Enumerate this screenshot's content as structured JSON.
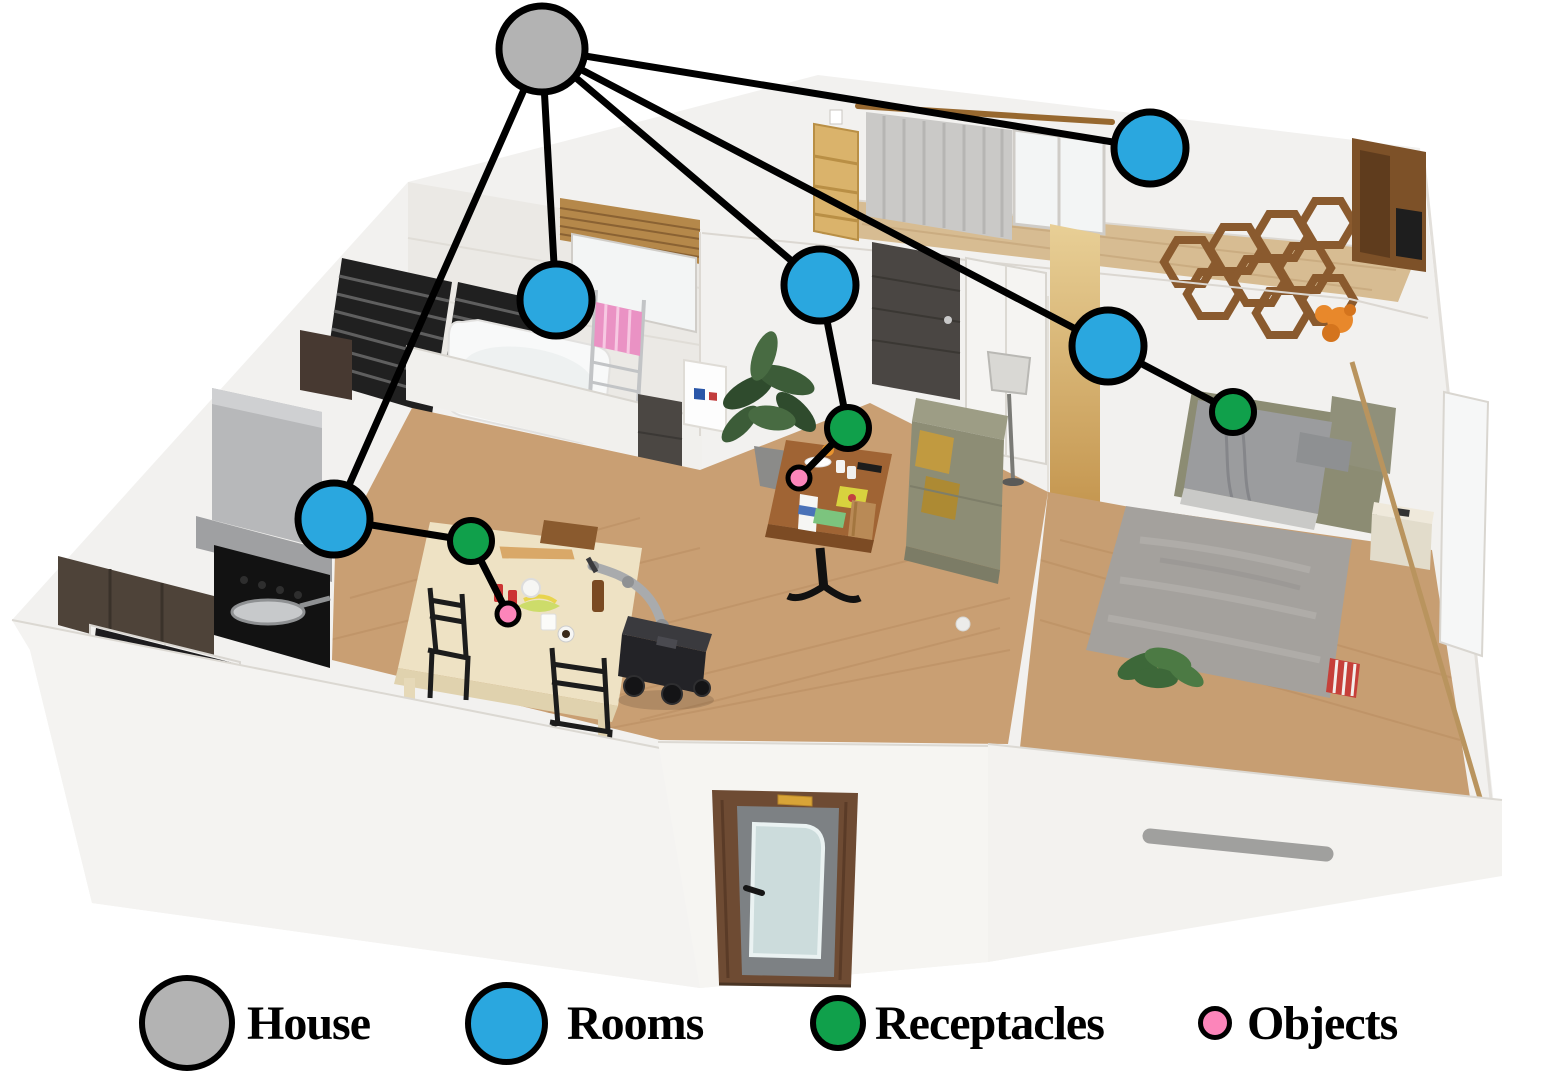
{
  "legend": {
    "items": [
      {
        "type": "house",
        "label": "House"
      },
      {
        "type": "room",
        "label": "Rooms"
      },
      {
        "type": "receptacle",
        "label": "Receptacles"
      },
      {
        "type": "object",
        "label": "Objects"
      }
    ]
  },
  "colors": {
    "house": "#b3b3b3",
    "room": "#2aa7df",
    "receptacle": "#10a04b",
    "object": "#fc85ba",
    "edge": "#000000"
  },
  "graph": {
    "edge_width": 7,
    "node_styles": {
      "house": {
        "r": 43,
        "stroke": 7
      },
      "room": {
        "r": 36,
        "stroke": 7
      },
      "receptacle": {
        "r": 21,
        "stroke": 6
      },
      "object": {
        "r": 11,
        "stroke": 5
      }
    },
    "nodes": [
      {
        "id": "house",
        "type": "house",
        "x": 542,
        "y": 49
      },
      {
        "id": "room-upper-bedroom",
        "type": "room",
        "x": 1150,
        "y": 148
      },
      {
        "id": "room-bathroom",
        "type": "room",
        "x": 556,
        "y": 300
      },
      {
        "id": "room-living",
        "type": "room",
        "x": 820,
        "y": 285
      },
      {
        "id": "room-bedroom",
        "type": "room",
        "x": 1108,
        "y": 346
      },
      {
        "id": "room-kitchen",
        "type": "room",
        "x": 334,
        "y": 519
      },
      {
        "id": "receptacle-living-coffee-table",
        "type": "receptacle",
        "x": 848,
        "y": 428
      },
      {
        "id": "receptacle-bedroom-bed",
        "type": "receptacle",
        "x": 1233,
        "y": 412
      },
      {
        "id": "receptacle-kitchen-table",
        "type": "receptacle",
        "x": 471,
        "y": 541
      },
      {
        "id": "object-living",
        "type": "object",
        "x": 799,
        "y": 478
      },
      {
        "id": "object-kitchen",
        "type": "object",
        "x": 508,
        "y": 614
      }
    ],
    "edges": [
      [
        "house",
        "room-upper-bedroom"
      ],
      [
        "house",
        "room-bathroom"
      ],
      [
        "house",
        "room-living"
      ],
      [
        "house",
        "room-bedroom"
      ],
      [
        "house",
        "room-kitchen"
      ],
      [
        "room-living",
        "receptacle-living-coffee-table"
      ],
      [
        "receptacle-living-coffee-table",
        "object-living"
      ],
      [
        "room-bedroom",
        "receptacle-bedroom-bed"
      ],
      [
        "room-kitchen",
        "receptacle-kitchen-table"
      ],
      [
        "receptacle-kitchen-table",
        "object-kitchen"
      ]
    ]
  }
}
